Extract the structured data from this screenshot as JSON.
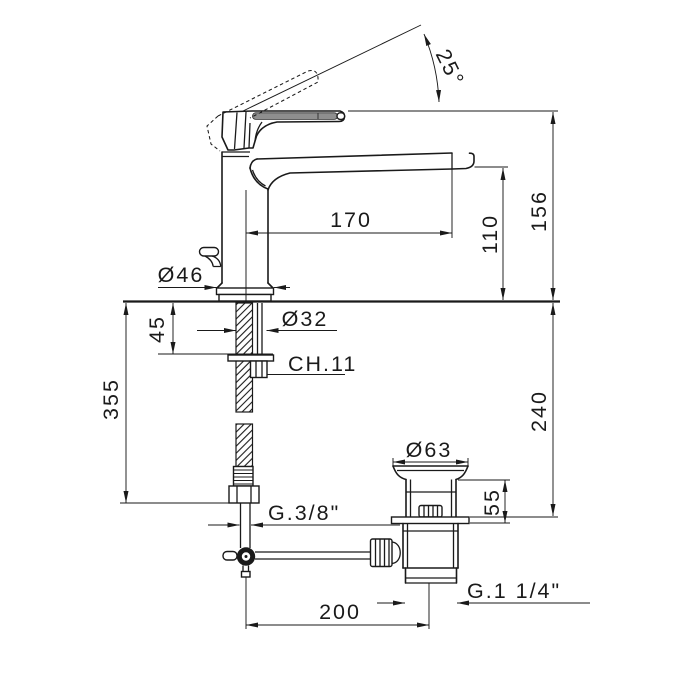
{
  "colors": {
    "ink": "#1a1a1a",
    "background": "#ffffff",
    "handle_grip": "#8f8f8f"
  },
  "labels": {
    "handle_angle": "25°",
    "spout_reach": "170",
    "spout_height": "110",
    "total_height": "156",
    "base_diameter": "Ø46",
    "shank_diameter": "Ø32",
    "deck_max_thickness": "45",
    "wrench_size": "CH.11",
    "below_deck_length": "355",
    "drain_depth": "240",
    "waste_top_diameter": "Ø63",
    "waste_top_height": "55",
    "supply_thread": "G.3/8\"",
    "rod_to_drain_distance": "200",
    "waste_thread": "G.1 1/4\""
  }
}
